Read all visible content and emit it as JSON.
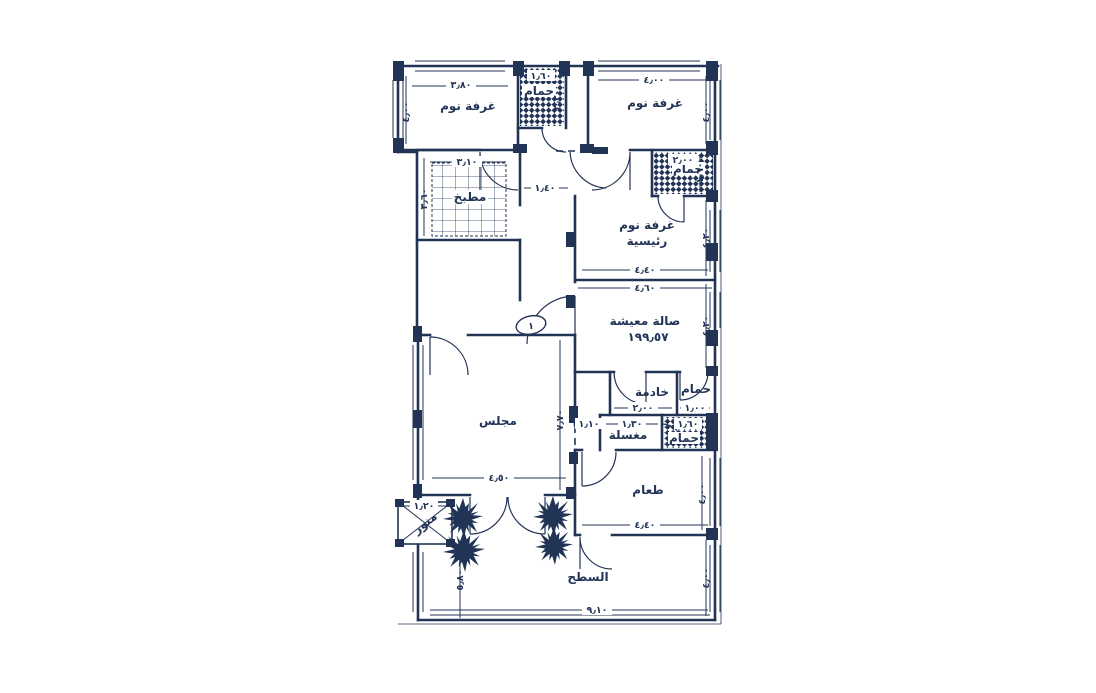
{
  "plan": {
    "type": "apartment-floor-plan",
    "language": "arabic",
    "ink_color": "#223456",
    "background_color": "#ffffff"
  },
  "rooms": {
    "bedroom1": "غرفة نوم",
    "bath_top": "حمام",
    "bedroom2": "غرفة نوم",
    "kitchen": "مطبخ",
    "bath_master": "حمام",
    "master_line1": "غرفة نوم",
    "master_line2": "رئيسية",
    "living": "صالة معيشة",
    "living_area_value": "١٩٩٫٥٧",
    "maid": "خادمة",
    "bath_maid": "حمام",
    "laundry": "مغسلة",
    "bath_small": "حمام",
    "majlis": "مجلس",
    "dining": "طعام",
    "roof": "السطح",
    "lightwell": "منور"
  },
  "dims": {
    "bedroom1_w": "٣٫٨٠",
    "bath_top_w": "١٫٦٠",
    "bedroom2_w": "٤٫٠٠",
    "kitchen_w": "٣٫١٠",
    "hall_w": "١٫٤٠",
    "bath_master_w": "٢٫٠٠",
    "master_w": "٤٫٤٠",
    "living_w": "٤٫٦٠",
    "maid_w": "٢٫٠٠",
    "bath_maid_w": "١٫٠٠",
    "laundry_w": "١٫٣٠",
    "bath_small_w": "١٫٦٠",
    "majlis_opening_w": "١٫١٠",
    "majlis_w": "٤٫٥٠",
    "dining_w": "٤٫٤٠",
    "roof_w": "٩٫١٠",
    "lightwell_w": "١٫٢٠",
    "bedroom1_h": "٤٫٠٠",
    "kitchen_h": "٣٫٦٠",
    "bath_top_h": "٢٫٢٠",
    "bedroom2_h": "٤٫٠٠",
    "bath_master_h": "١٫٦٠",
    "master_h": "٤٫٢٠",
    "living_h": "٤٫٢٠",
    "majlis_h": "٧٫٧٠",
    "dining_h": "٤٫٠٠",
    "roof_h_right": "٤٫٠٠",
    "roof_h_left": "٥٫٨٠",
    "entry_mark": "١"
  }
}
